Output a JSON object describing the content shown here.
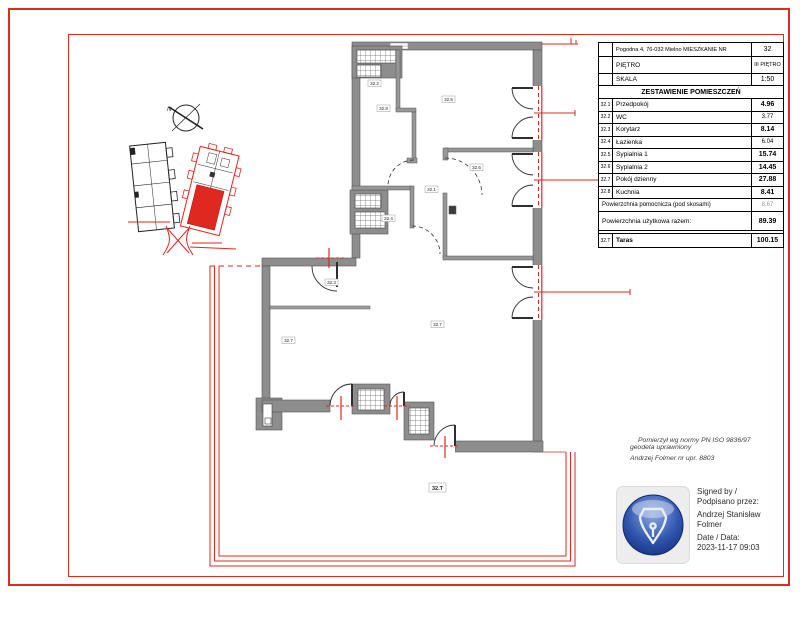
{
  "colors": {
    "frame_red": "#de2b22",
    "plan_red": "#de2820",
    "wall_gray": "#8d8d8d",
    "wall_edge": "#555555",
    "door_black": "#2e2e2e",
    "stamp_blue_dark": "#1b3a8f",
    "stamp_blue_light": "#8fa9e0",
    "stamp_panel_gray": "#ededed"
  },
  "info_table": {
    "header_rows": [
      {
        "label": "Pogodna 4, 76-032 Mielno MIESZKANIE NR",
        "value": "32"
      },
      {
        "label": "PIĘTRO",
        "value": "III PIĘTRO"
      },
      {
        "label": "SKALA",
        "value": "1:50"
      }
    ],
    "section_title": "ZESTAWIENIE POMIESZCZEŃ",
    "rooms": [
      {
        "no": "32.1",
        "name": "Przedpokój",
        "area": "4.96"
      },
      {
        "no": "32.2",
        "name": "WC",
        "area": "3.77"
      },
      {
        "no": "32.3",
        "name": "Korytarz",
        "area": "8.14"
      },
      {
        "no": "32.4",
        "name": "Łazienka",
        "area": "6.04"
      },
      {
        "no": "32.5",
        "name": "Sypialnia 1",
        "area": "15.74"
      },
      {
        "no": "32.6",
        "name": "Sypialnia 2",
        "area": "14.45"
      },
      {
        "no": "32.7",
        "name": "Pokój dzienny",
        "area": "27.88"
      },
      {
        "no": "32.8",
        "name": "Kuchnia",
        "area": "8.41"
      }
    ],
    "summary": [
      {
        "label": "Powierzchnia pomocnicza (pod skosami)",
        "value": "8.67"
      },
      {
        "label": "Powierzchnia użytkowa razem:",
        "value": "89.39"
      }
    ],
    "terrace_row": {
      "no": "32.T",
      "name": "Taras",
      "value": "100.15"
    }
  },
  "notes": {
    "line1": "Pomierzył wg normy  PN ISO 9836/97",
    "line2": "geodeta uprawniony",
    "line3": "Andrzej Folmer nr upr. 8803"
  },
  "signature": {
    "line1": "Signed by /",
    "line2": "Podpisano przez:",
    "name1": "Andrzej Stanisław",
    "name2": "Folmer",
    "date_label": "Date / Data:",
    "date_value": "2023-11-17 09:03"
  },
  "plan": {
    "north": "N",
    "labels": [
      "32.2",
      "32.8",
      "32.5",
      "32.6",
      "32.4",
      "32.1",
      "32.3",
      "32.7",
      "32.7"
    ],
    "terrace_label": "32.T"
  }
}
